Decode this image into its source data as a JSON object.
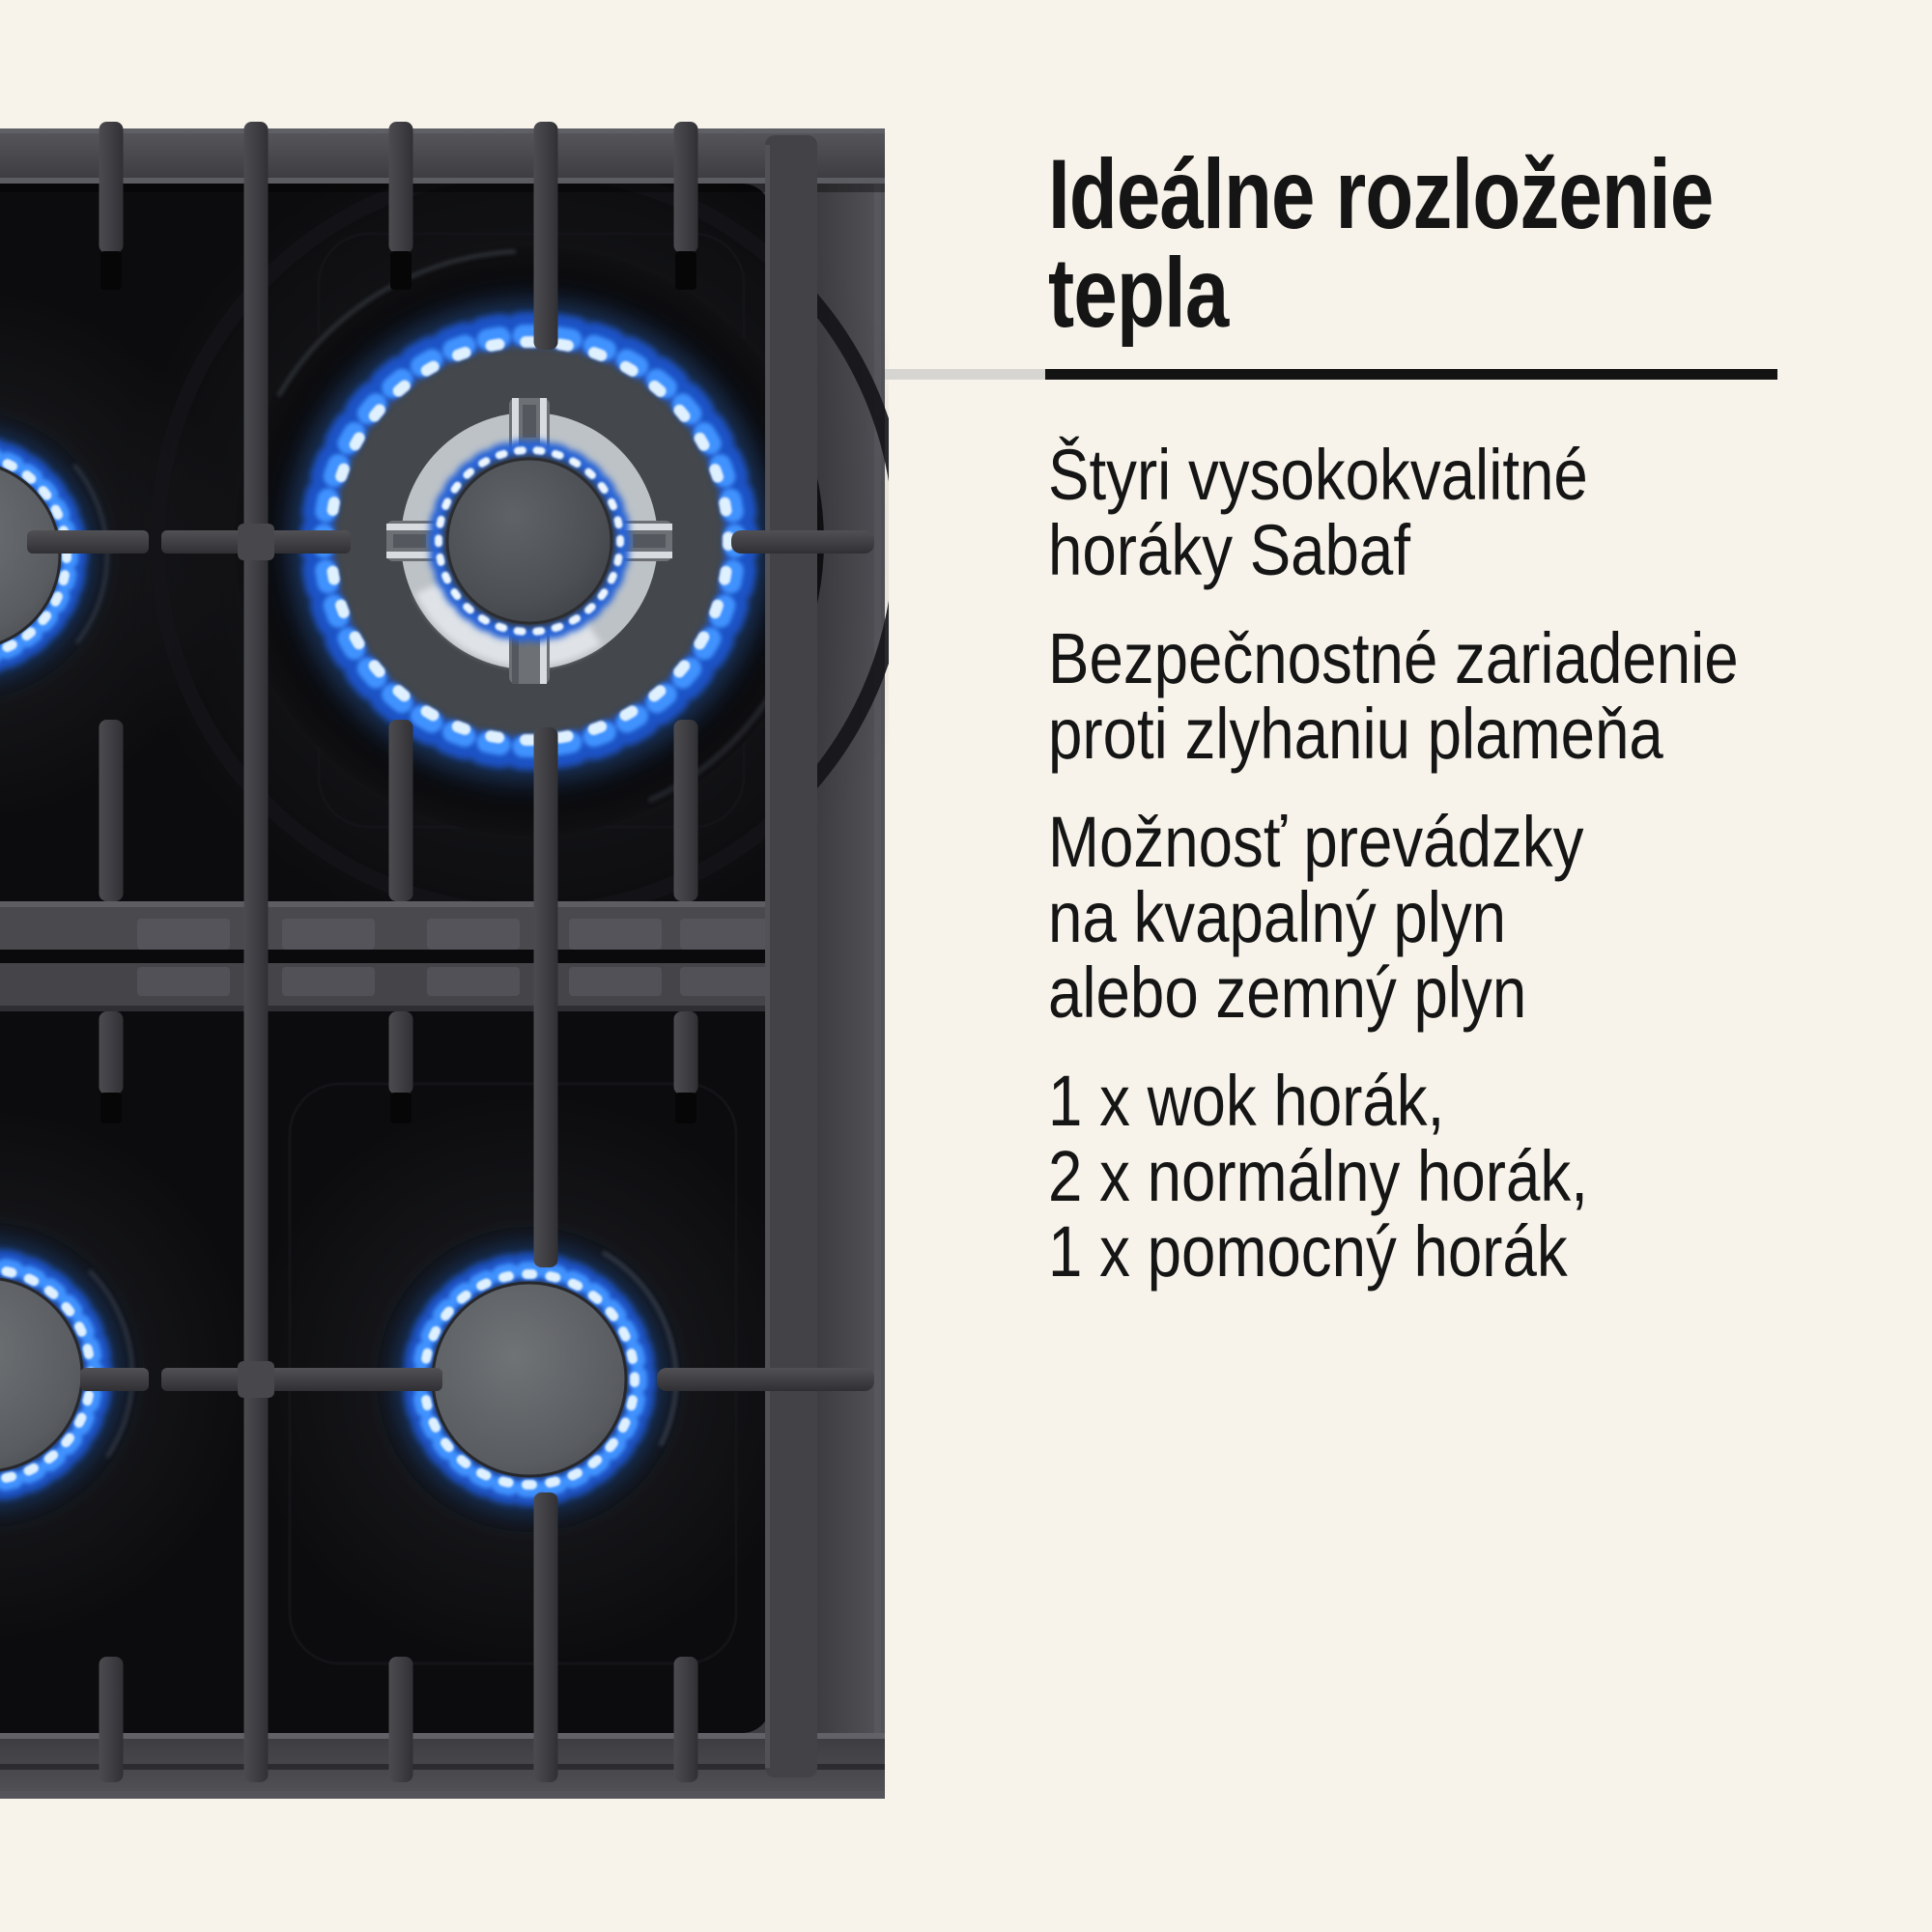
{
  "title": "Ideálne rozloženie\ntepla",
  "features": [
    {
      "text": "Štyri vysokokvalitné\nhoráky Sabaf"
    },
    {
      "text": "Bezpečnostné zariadenie\nproti zlyhaniu plameňa"
    },
    {
      "text": "Možnosť prevádzky\nna kvapalný plyn\nalebo zemný plyn"
    },
    {
      "text": "1 x wok horák,\n2 x normálny horák,\n1 x pomocný horák"
    }
  ],
  "theme": {
    "bg": "#f7f3ea",
    "text": "#151515",
    "divider-dark": "#131313",
    "divider-light": "#d6d5d1"
  },
  "image_colors": {
    "hob_glass": "#0c0c0e",
    "hob_frame": "#46464a",
    "grate": "#3f3f43",
    "chrome_ring": "#bdc2c7",
    "flame_deep_blue": "#1c55cc",
    "flame_mid_blue": "#4092ff",
    "flame_core": "#dff0ff"
  }
}
